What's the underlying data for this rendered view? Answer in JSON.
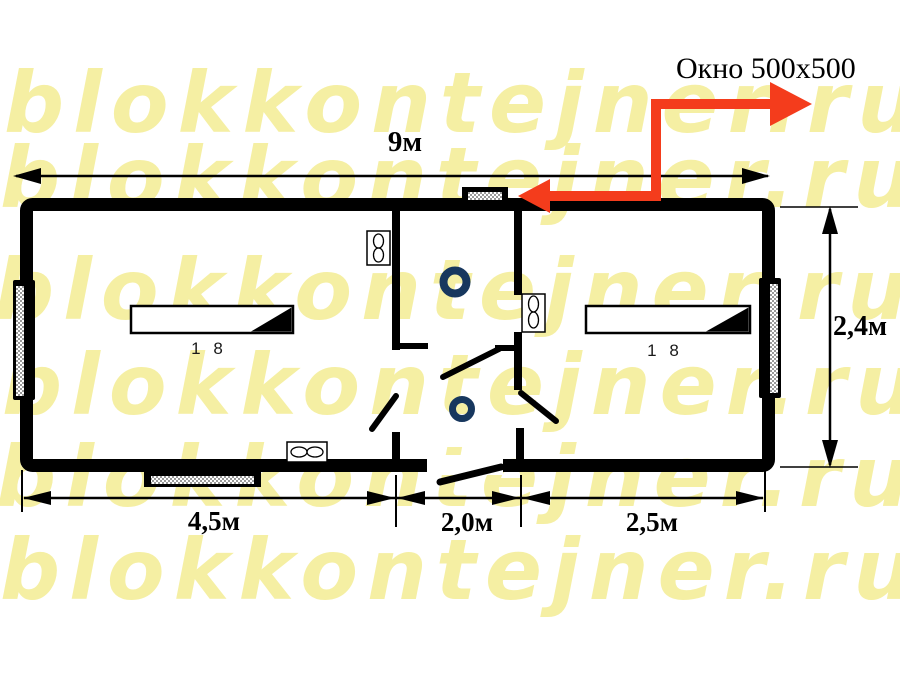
{
  "watermark": {
    "text": "blokkontejner.ru",
    "color": "#f5efa3",
    "rows": 6
  },
  "callout": {
    "window_label": "Окно 500x500",
    "arrow_color": "#f43c1c"
  },
  "dimensions": {
    "total_length": "9м",
    "height": "2,4м",
    "left_room": "4,5м",
    "middle_room": "2,0м",
    "right_room": "2,5м"
  },
  "radiators": {
    "left_label": "1 8",
    "right_label": "1 8"
  },
  "colors": {
    "wall": "#000000",
    "ring_blue": "#17375e",
    "arrow_red": "#f43c1c",
    "watermark_yellow": "#f5efa3",
    "window_hatch_gray": "#9a9a9a"
  }
}
